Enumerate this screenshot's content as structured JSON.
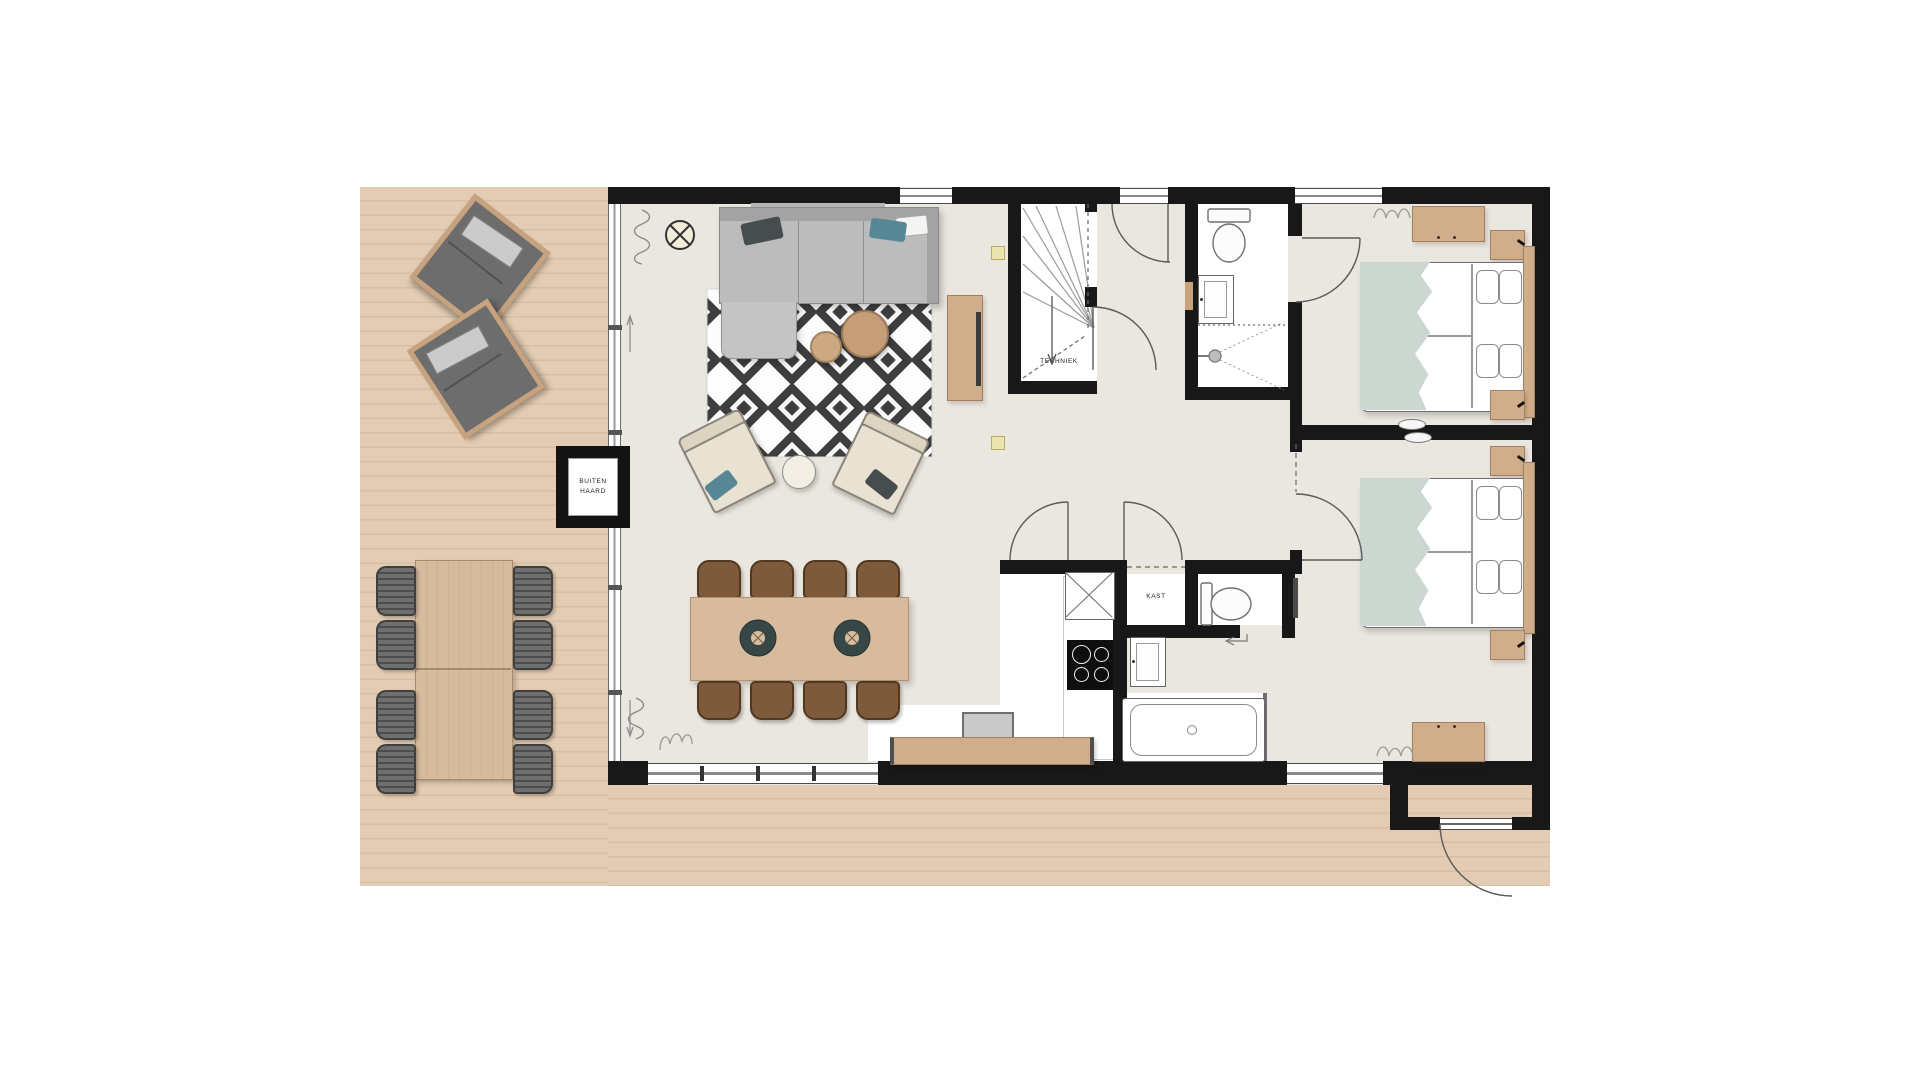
{
  "plan": {
    "type": "residential-floor-plan",
    "labels": {
      "outdoor_fireplace_line1": "BUITEN",
      "outdoor_fireplace_line2": "HAARD",
      "technical_room": "TECHNIEK",
      "closet": "KAST"
    },
    "colors": {
      "wall": "#181818",
      "deck_wood": "#e3ccb3",
      "interior_floor": "#eae6e0",
      "wet_zone": "#ffffff",
      "wood_furniture": "#d0ae8c",
      "dining_chair": "#7c5a3b",
      "sofa_gray": "#b9b9b9",
      "rug_pattern": "#3e3e3e",
      "teal_accent": "#578794",
      "bed_blanket": "#cdd7d2"
    },
    "areas": {
      "terrace": [
        "lounge-chair",
        "lounge-chair",
        "outdoor-dining-table",
        "outdoor-chairs-x8",
        "outdoor-fireplace"
      ],
      "living_room": [
        "ceiling-light",
        "corner-sofa",
        "geometric-rug",
        "coffee-table-large",
        "coffee-table-small",
        "armchair",
        "armchair",
        "side-table",
        "dining-table",
        "dining-chairs-x8",
        "tv-cabinet",
        "tv-sideboard"
      ],
      "core": [
        "staircase",
        "technical-room",
        "closet",
        "kitchen-counter",
        "cooktop",
        "appliance",
        "washbasin",
        "bathtub"
      ],
      "bathroom": [
        "toilet",
        "washbasin",
        "shower"
      ],
      "toilet_room": [
        "toilet"
      ],
      "bedroom_1": [
        "double-bed",
        "nightstand",
        "nightstand",
        "dresser"
      ],
      "bedroom_2": [
        "double-bed",
        "nightstand",
        "nightstand",
        "desk"
      ]
    }
  }
}
